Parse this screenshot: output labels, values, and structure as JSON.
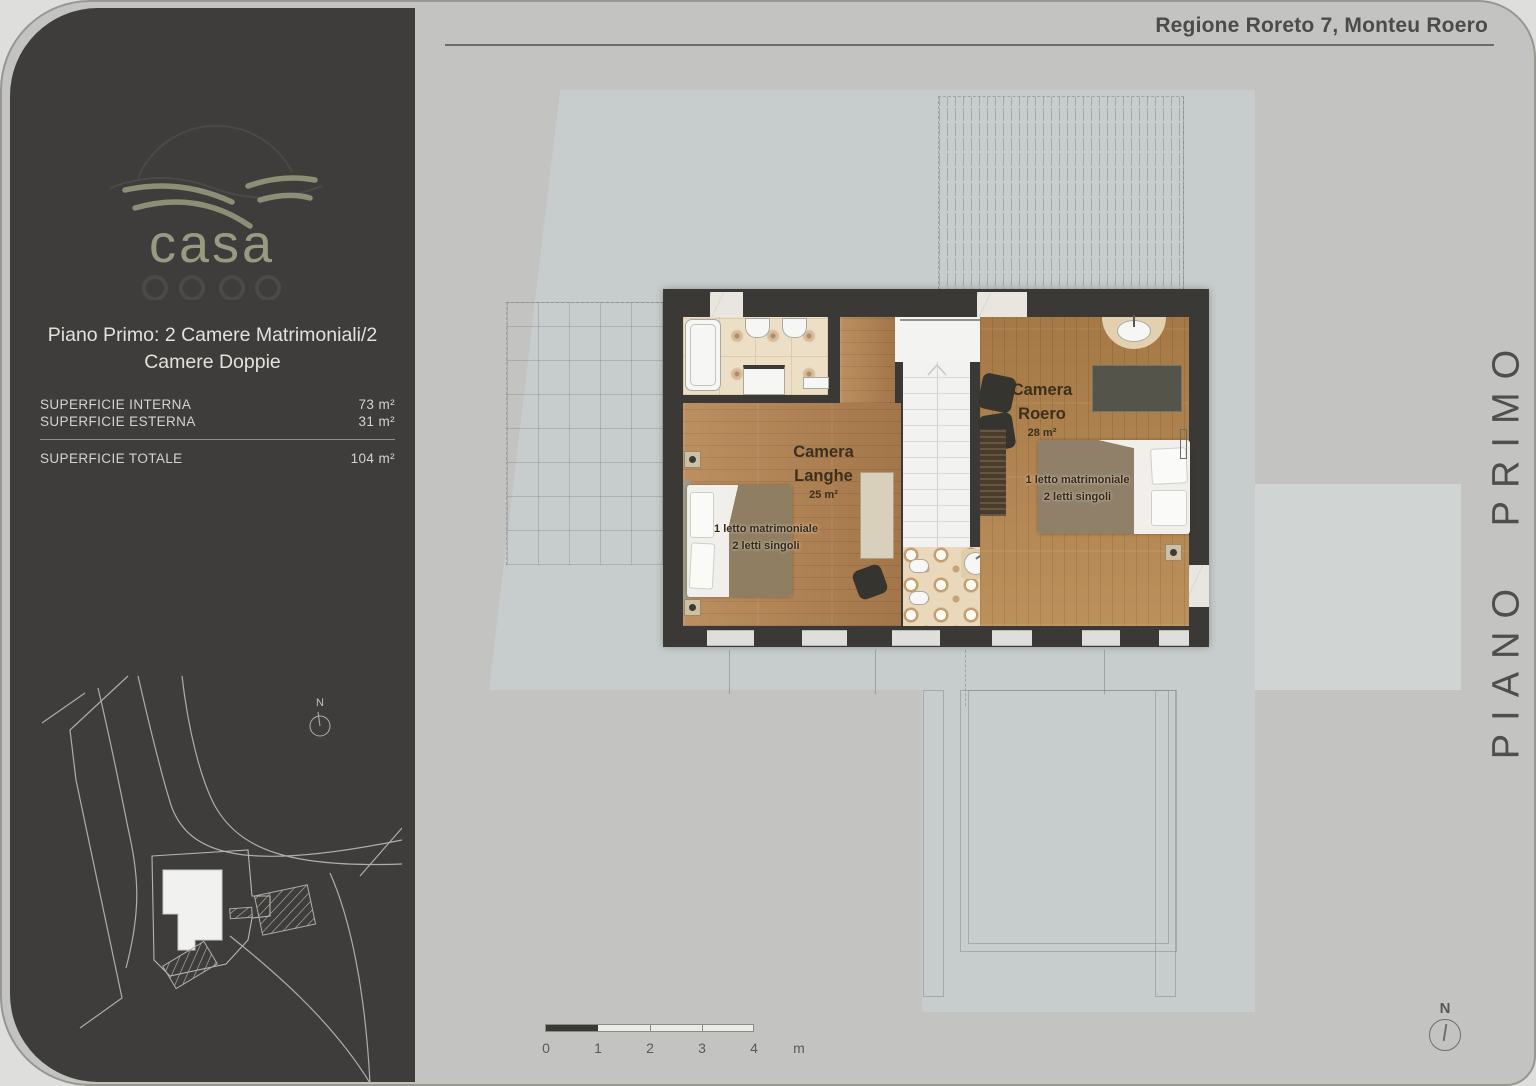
{
  "header": {
    "address": "Regione Roreto 7, Monteu Roero"
  },
  "sidebar": {
    "brand": "casa",
    "plan_title": "Piano Primo: 2 Camere Matrimoniali/2 Camere Doppie",
    "metrics": [
      {
        "label": "SUPERFICIE INTERNA",
        "value": "73 m²"
      },
      {
        "label": "SUPERFICIE ESTERNA",
        "value": "31 m²"
      }
    ],
    "total": {
      "label": "SUPERFICIE TOTALE",
      "value": "104 m²"
    }
  },
  "plan": {
    "rooms": [
      {
        "name": "Camera Langhe",
        "area": "25 m²",
        "bed_line1": "1 letto matrimoniale",
        "bed_line2": "2 letti singoli"
      },
      {
        "name": "Camera Roero",
        "area": "28 m²",
        "bed_line1": "1 letto matrimoniale",
        "bed_line2": "2 letti singoli"
      }
    ]
  },
  "floor_label": "PIANO PRIMO",
  "compass": {
    "label": "N"
  },
  "scalebar": {
    "ticks": [
      "0",
      "1",
      "2",
      "3",
      "4"
    ],
    "unit": "m"
  },
  "colors": {
    "accent_olive": "#8e8e76",
    "wall": "#3a3936",
    "terrace": "#c7cccc",
    "sidebar": "#3e3d3b"
  }
}
